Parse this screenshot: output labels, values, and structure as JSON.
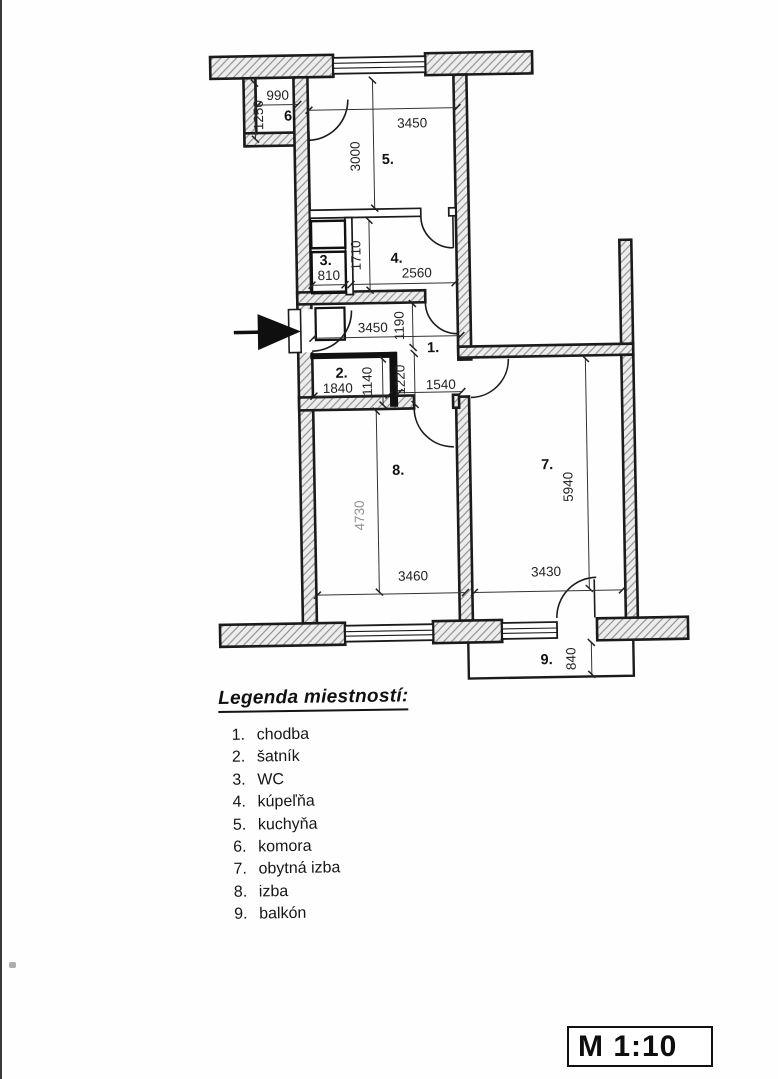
{
  "plan": {
    "room_labels": {
      "hall": "1.",
      "wardrobe": "2.",
      "wc": "3.",
      "bathroom": "4.",
      "kitchen": "5.",
      "pantry": "6.",
      "living_room": "7.",
      "room": "8.",
      "balcony": "9."
    },
    "dims": {
      "room6_width": "990",
      "room6_height": "1250",
      "room5_width": "3450",
      "room5_height": "3000",
      "room3_width": "810",
      "room34_height": "1710",
      "room4_width": "2560",
      "hall_width": "3450",
      "hall_height": "1190",
      "hall_lower_width": "1540",
      "hall_passage_height": "1220",
      "room2_width": "1840",
      "room2_height": "1140",
      "room8_width": "3460",
      "room8_height": "4730",
      "room7_width": "3430",
      "room7_height": "5940",
      "balcony_depth": "840"
    }
  },
  "legend": {
    "title": "Legenda miestností:",
    "items": [
      {
        "num": "1.",
        "name": "chodba"
      },
      {
        "num": "2.",
        "name": "šatník"
      },
      {
        "num": "3.",
        "name": "WC"
      },
      {
        "num": "4.",
        "name": "kúpeľňa"
      },
      {
        "num": "5.",
        "name": "kuchyňa"
      },
      {
        "num": "6.",
        "name": "komora"
      },
      {
        "num": "7.",
        "name": "obytná izba"
      },
      {
        "num": "8.",
        "name": "izba"
      },
      {
        "num": "9.",
        "name": "balkón"
      }
    ]
  },
  "scale": {
    "label": "M 1:10"
  },
  "colors": {
    "ink": "#1b1b1b",
    "wall_fill": "#ededed",
    "hatch_line": "#8a8a8a",
    "dim_gray": "#8f8f8f"
  }
}
